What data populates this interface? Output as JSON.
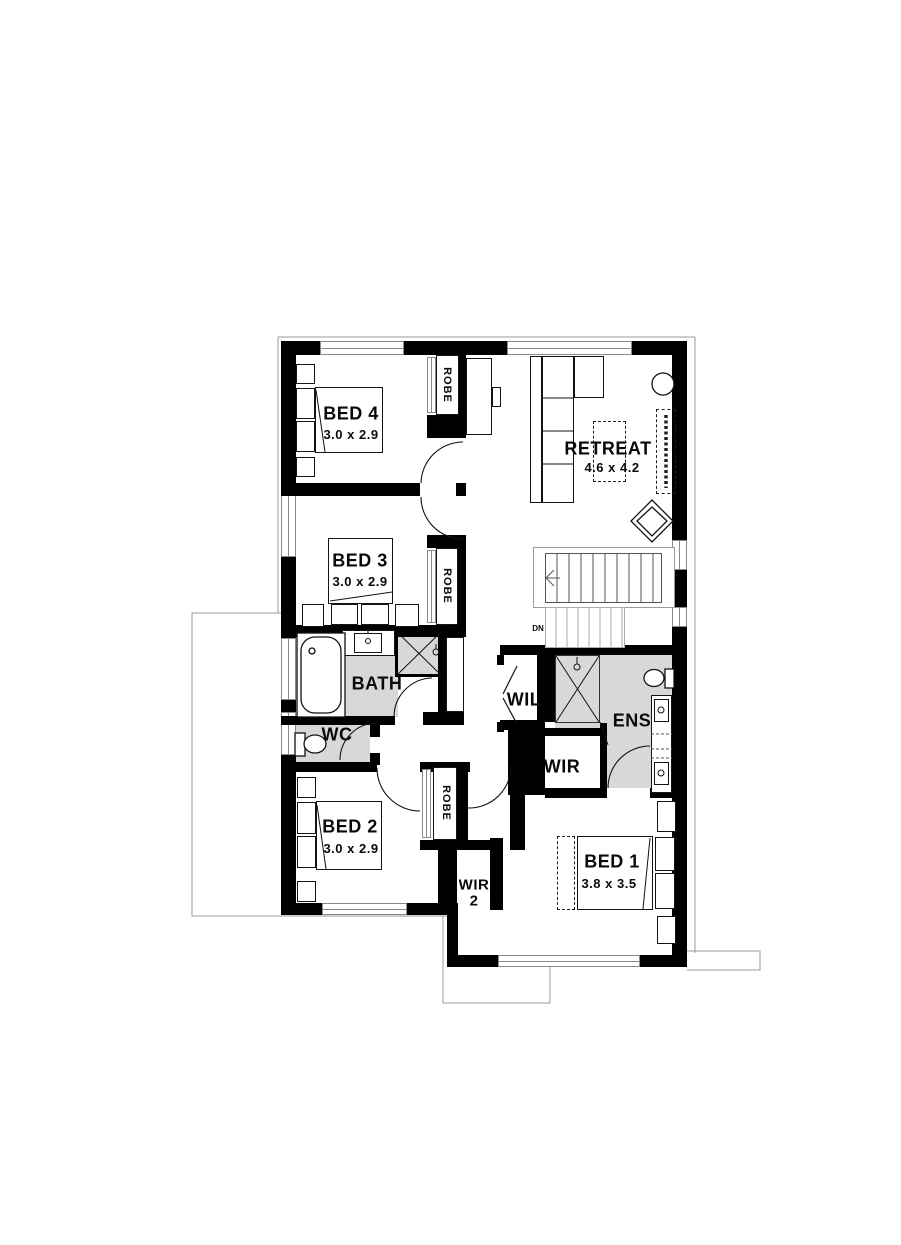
{
  "plan": {
    "rooms": {
      "bed1": {
        "name": "BED 1",
        "dims": "3.8 x 3.5"
      },
      "bed2": {
        "name": "BED 2",
        "dims": "3.0 x 2.9"
      },
      "bed3": {
        "name": "BED 3",
        "dims": "3.0 x 2.9"
      },
      "bed4": {
        "name": "BED 4",
        "dims": "3.0 x 2.9"
      },
      "retreat": {
        "name": "RETREAT",
        "dims": "4.6 x 4.2"
      },
      "bath": {
        "name": "BATH"
      },
      "wc": {
        "name": "WC"
      },
      "ens": {
        "name": "ENS"
      },
      "wil": {
        "name": "WIL"
      },
      "wir": {
        "name": "WIR"
      },
      "wir2": {
        "name": "WIR",
        "number": "2"
      },
      "robe": {
        "name": "ROBE"
      }
    },
    "stairs": {
      "direction_label": "DN"
    },
    "colors": {
      "wall": "#000000",
      "wet_area_floor": "#d8d8d8",
      "roof_outline": "#9b9b9b"
    }
  }
}
